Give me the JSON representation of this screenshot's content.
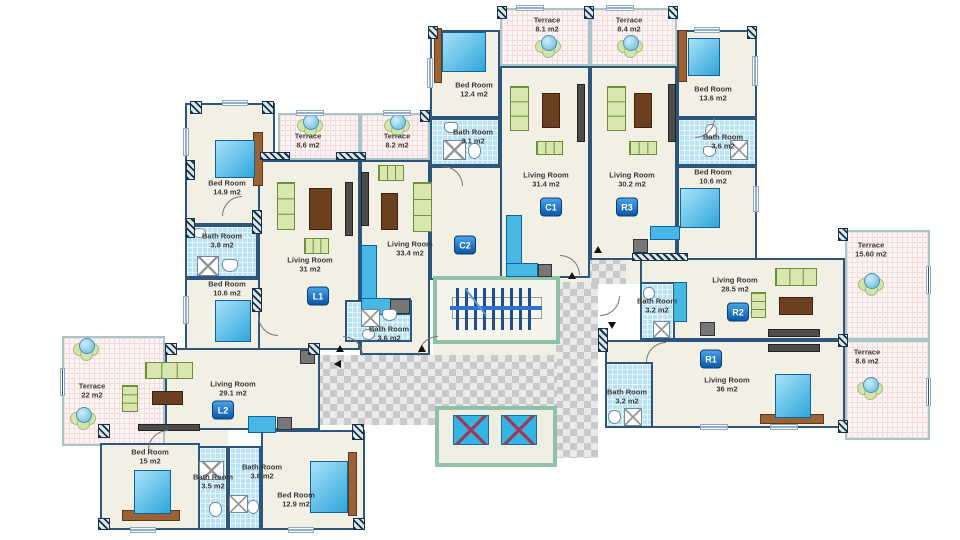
{
  "units": [
    "L1",
    "L2",
    "C1",
    "C2",
    "R1",
    "R2",
    "R3"
  ],
  "rooms": [
    {
      "name": "Terrace",
      "area": "8.6 m2"
    },
    {
      "name": "Terrace",
      "area": "8.2 m2"
    },
    {
      "name": "Terrace",
      "area": "8.1 m2"
    },
    {
      "name": "Terrace",
      "area": "8.4 m2"
    },
    {
      "name": "Bed Room",
      "area": "12.4 m2"
    },
    {
      "name": "Bed Room",
      "area": "13.6 m2"
    },
    {
      "name": "Bath Room",
      "area": "3.1 m2"
    },
    {
      "name": "Bath Room",
      "area": "3.6 m2"
    },
    {
      "name": "Bed Room",
      "area": "10.6 m2"
    },
    {
      "name": "Living Room",
      "area": "31.4  m2"
    },
    {
      "name": "Living Room",
      "area": "30.2  m2"
    },
    {
      "name": "Bed Room",
      "area": "14.9 m2"
    },
    {
      "name": "Bath Room",
      "area": "3.8 m2"
    },
    {
      "name": "Bed Room",
      "area": "10.6 m2"
    },
    {
      "name": "Living Room",
      "area": "31 m2"
    },
    {
      "name": "Living Room",
      "area": "33.4  m2"
    },
    {
      "name": "Terrace",
      "area": "15.60 m2"
    },
    {
      "name": "Living Room",
      "area": "28.5 m2"
    },
    {
      "name": "Bath Room",
      "area": "3.2 m2"
    },
    {
      "name": "Bath Room",
      "area": "3.6 m2"
    },
    {
      "name": "Living Room",
      "area": "36  m2"
    },
    {
      "name": "Terrace",
      "area": "8.6 m2"
    },
    {
      "name": "Bath Room",
      "area": "3.2 m2"
    },
    {
      "name": "Terrace",
      "area": "22 m2"
    },
    {
      "name": "Living Room",
      "area": "29.1 m2"
    },
    {
      "name": "Bed Room",
      "area": "15 m2"
    },
    {
      "name": "Bath Room",
      "area": "3.5 m2"
    },
    {
      "name": "Bath Room",
      "area": "3.8 m2"
    },
    {
      "name": "Bed Room",
      "area": "12.9 m2"
    }
  ],
  "colors": {
    "floor": "#f2efe4",
    "wall": "#2e567d",
    "terrace_floor": "#fdf3f2",
    "bath_tile": "#b9e2f3",
    "service_wall": "#8fc0aa",
    "badge": "#0b57a8",
    "bed": "#2ea6db",
    "sofa": "#d9e7ae",
    "table": "#6b3f1f",
    "elevator": "#35b3e2",
    "elevator_cross": "#a03a50",
    "checker": "#c9c9c9"
  }
}
